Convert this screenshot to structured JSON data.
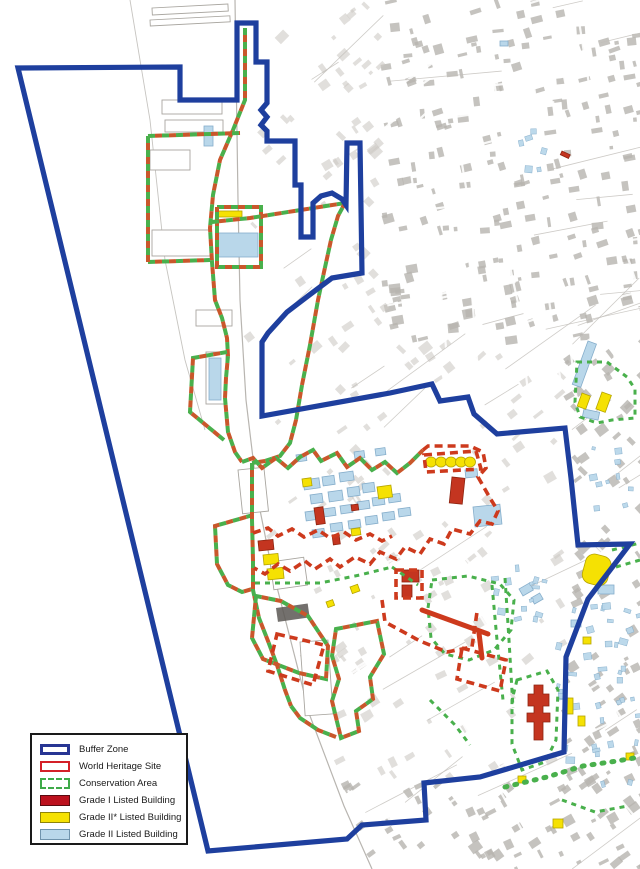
{
  "legend": {
    "items": [
      {
        "label": "Buffer Zone",
        "swatch": "buffer"
      },
      {
        "label": "World Heritage Site",
        "swatch": "whs"
      },
      {
        "label": "Conservation Area",
        "swatch": "conservation"
      },
      {
        "label": "Grade I Listed Building",
        "swatch": "grade1"
      },
      {
        "label": "Grade II* Listed Building",
        "swatch": "grade2star"
      },
      {
        "label": "Grade II Listed Building",
        "swatch": "grade2"
      }
    ]
  },
  "map": {
    "colors": {
      "buffer_blue": "#1e3f9e",
      "whs_red": "#cd3a1d",
      "combined_red": "#c9572b",
      "conservation_green": "#49b04c",
      "grade1_fill": "#c43520",
      "grade1_stroke": "#8e2410",
      "grade2star_fill": "#f5e103",
      "grade2star_stroke": "#b5a400",
      "grade2_fill": "#b9d7ea",
      "grade2_stroke": "#86aecb",
      "texture_light": "#cdcac5",
      "texture_dark": "#b7b4af",
      "shore_line": "#b8b5b0"
    },
    "buffer_path": "M18,68 L180,67 L180,100 L237,100 L237,23 L256,23 L256,62 L267,62 L267,103 L261,110 L267,117 L261,125 L267,131 L267,141 L295,141 L295,185 L301,185 L301,237 L313,237 L313,203 L321,196 L332,193 L342,199 L346,205 L347,143 L360,143 L362,273 L332,278 L308,296 L287,312 L268,333 L262,342 L262,416 L390,393 L432,384 L440,401 L468,397 L474,414 L497,434 L565,428 L571,478 L578,545 L630,544 L588,599 L566,657 L564,752 L480,777 L424,783 L426,820 L362,825 L347,839 L208,851 Z",
    "shore_path": "M235,0 L238,200 L240,300 L246,400 L258,500 L270,560 L288,630 L310,716 L344,806 L372,869",
    "outer_pier_path": "M130,0 L150,120 L165,260 L185,360 L205,430",
    "combined_paths": [
      "M245,28 L245,100 L233,130 L220,160 L213,195 L210,228 L212,262 L215,300 L222,318 L227,338 L228,356 L226,378 L225,398 L228,432 L235,452 L242,462",
      "M148,136 L240,133",
      "M148,136 L148,262 L210,260",
      "M217,207 L261,207 L261,267 L217,267 Z",
      "M212,222 L250,218 L345,203 L338,216 L331,240 L324,272 L318,300 L310,345 L302,385 L296,420 L290,443 L280,456 L265,461 L252,463",
      "M242,462 L253,458 L262,468 L276,458 L288,468 L300,457 L313,450 L321,461 L337,453 L347,467 L360,458 L372,470 L385,462 L397,473 L410,463 L423,450",
      "M253,515 L215,526 L217,564 L228,585 L242,592 L252,589",
      "M227,352 L193,358 L190,412 L224,440",
      "M252,463 L252,520 L253,560 L253,590 L259,618 L268,641 L277,665 L285,690 L291,706",
      "M256,596 L252,638 L263,659 L299,673 L326,679 L328,646 L308,616 L281,601 Z",
      "M336,629 L377,621 L384,654 L370,677 L373,699 L356,711 L359,731 L341,738 L332,701 L339,679 L332,656 Z",
      "M291,706 L300,718 L318,730 L336,737"
    ],
    "red_paths": [
      "M423,450 L428,446 L470,446 L483,452 L486,468 L478,477 L490,498 L498,511 L492,524 L480,521 L470,534 L452,529 L444,544 L430,539 L420,554 L405,547 L396,559 L380,552 L370,564 L355,557 L340,567 L330,559 L315,569 L305,561 L290,571 L278,564 L265,574 L254,568",
      "M424,455 L476,451 L481,469 L426,472 Z",
      "M396,570 L422,570 L422,598 L396,598 Z",
      "M382,600 L385,622 L420,641 L447,652 L472,647 L477,612",
      "M462,648 L506,660 L500,691 L457,679 Z",
      "M277,634 L324,645 L313,685 L268,671 Z",
      "M253,533 L268,528 L278,536 L292,529 L304,537 L318,530 L330,538 L344,532 L356,540 L370,534 L382,541 L392,536"
    ],
    "red_solid_paths": [
      "M422,610 L488,634",
      "M479,633 L482,658"
    ],
    "green_paths": [
      "M255,583 L320,583 L360,575 L392,567",
      "M432,580 L468,576 L500,584 L514,600 L511,630 L494,650 L469,660 L445,654 L431,638 L428,608 Z",
      "M505,578 L509,640 L513,708",
      "M492,585 L497,640 L503,700",
      "M517,680 L547,671 L558,690 L556,740 L545,762 L522,770 L512,744 L512,700 Z",
      "M577,362 L607,362 L627,377 L635,389 L635,418 L612,420 L597,423 L580,417 L575,402 Z",
      "M612,550 L640,543",
      "M616,567 L640,560",
      "M392,567 L405,576 L418,585",
      "M430,700 L455,725 L470,745",
      "M562,800 L595,812 L628,806"
    ],
    "green_dot_paths": [
      "M505,787 L547,777 L583,766 L617,761 L640,757"
    ],
    "dock_outlines": [
      [
        152,
        8,
        76,
        7,
        -3
      ],
      [
        150,
        20,
        80,
        6,
        -3
      ],
      [
        162,
        100,
        60,
        14,
        0
      ],
      [
        165,
        120,
        58,
        12,
        0
      ],
      [
        150,
        150,
        40,
        20,
        0
      ],
      [
        152,
        230,
        58,
        26,
        0
      ],
      [
        196,
        310,
        36,
        16,
        0
      ],
      [
        206,
        352,
        20,
        52,
        0
      ],
      [
        238,
        470,
        26,
        44,
        -6
      ],
      [
        270,
        562,
        34,
        28,
        -8
      ],
      [
        300,
        642,
        28,
        74,
        -4
      ]
    ],
    "dark_block": [
      276,
      608,
      32,
      14,
      -8
    ],
    "buildings": {
      "grade2": [
        [
          218,
          233,
          40,
          24,
          0
        ],
        [
          209,
          358,
          12,
          42,
          0
        ],
        [
          204,
          126,
          9,
          20,
          0
        ],
        [
          303,
          480,
          16,
          10,
          -8
        ],
        [
          322,
          477,
          12,
          9,
          -8
        ],
        [
          339,
          473,
          14,
          9,
          -8
        ],
        [
          310,
          495,
          12,
          9,
          -8
        ],
        [
          328,
          492,
          14,
          10,
          -8
        ],
        [
          347,
          488,
          12,
          9,
          -8
        ],
        [
          362,
          484,
          12,
          9,
          -8
        ],
        [
          305,
          512,
          14,
          9,
          -8
        ],
        [
          323,
          509,
          12,
          8,
          -8
        ],
        [
          340,
          506,
          12,
          8,
          -8
        ],
        [
          357,
          502,
          12,
          8,
          -8
        ],
        [
          372,
          498,
          12,
          8,
          -8
        ],
        [
          388,
          495,
          12,
          8,
          -8
        ],
        [
          330,
          524,
          12,
          8,
          -8
        ],
        [
          348,
          521,
          12,
          8,
          -8
        ],
        [
          365,
          517,
          12,
          8,
          -8
        ],
        [
          382,
          513,
          12,
          8,
          -8
        ],
        [
          398,
          509,
          12,
          8,
          -8
        ],
        [
          312,
          530,
          12,
          8,
          -8
        ],
        [
          473,
          507,
          27,
          20,
          -6
        ],
        [
          465,
          470,
          12,
          8,
          -6
        ],
        [
          588,
          341,
          9,
          46,
          20
        ],
        [
          584,
          409,
          16,
          8,
          12
        ],
        [
          519,
          589,
          12,
          8,
          -30
        ],
        [
          531,
          598,
          10,
          7,
          -30
        ],
        [
          354,
          452,
          10,
          7,
          -8
        ],
        [
          375,
          449,
          10,
          7,
          -8
        ],
        [
          598,
          585,
          16,
          9,
          0
        ],
        [
          571,
          620,
          10,
          7,
          0
        ],
        [
          296,
          455,
          10,
          7,
          -8
        ],
        [
          500,
          41,
          8,
          5,
          0
        ]
      ],
      "grade2star": [
        [
          216,
          211,
          26,
          6,
          0
        ],
        [
          263,
          555,
          15,
          10,
          -6
        ],
        [
          267,
          569,
          16,
          11,
          -6
        ],
        [
          377,
          487,
          14,
          12,
          -8
        ],
        [
          302,
          479,
          9,
          8,
          -8
        ],
        [
          351,
          529,
          9,
          7,
          -8
        ],
        [
          582,
          393,
          9,
          14,
          20
        ],
        [
          602,
          392,
          10,
          18,
          20
        ],
        [
          566,
          698,
          7,
          16,
          0
        ],
        [
          578,
          716,
          7,
          10,
          0
        ],
        [
          518,
          776,
          8,
          7,
          0
        ],
        [
          553,
          819,
          10,
          9,
          0
        ],
        [
          626,
          753,
          8,
          7,
          0
        ],
        [
          583,
          637,
          8,
          7,
          0
        ],
        [
          350,
          587,
          8,
          7,
          -20
        ],
        [
          326,
          602,
          7,
          6,
          -20
        ]
      ],
      "grade2star_blob": [
        588,
        552,
        26,
        30,
        15
      ],
      "grade2star_ellipses": {
        "cy": 462,
        "rx": 5.5,
        "ry": 5,
        "cx": [
          431,
          441,
          451,
          461,
          470
        ]
      },
      "grade1_rects": [
        [
          258,
          541,
          15,
          10,
          -6
        ],
        [
          314,
          508,
          9,
          17,
          -8
        ],
        [
          351,
          505,
          7,
          6,
          -8
        ],
        [
          332,
          535,
          7,
          10,
          -8
        ],
        [
          402,
          570,
          17,
          12,
          0
        ],
        [
          402,
          585,
          10,
          12,
          0
        ],
        [
          562,
          151,
          9,
          4,
          25
        ]
      ],
      "grade1_stgeorges": [
        452,
        477,
        13,
        26,
        6
      ],
      "grade1_cathedral": "M534,685 h9 v9 h6 v12 h-6 v7 h7 v9 h-7 v18 h-9 v-18 h-7 v-9 h7 v-7 h-6 v-12 h6 Z"
    },
    "scatter_zones": [
      [
        556,
        600,
        82,
        100,
        26
      ],
      [
        490,
        560,
        54,
        62,
        14
      ],
      [
        586,
        430,
        50,
        80,
        10
      ],
      [
        546,
        700,
        90,
        84,
        14
      ],
      [
        500,
        128,
        56,
        40,
        6
      ]
    ]
  }
}
